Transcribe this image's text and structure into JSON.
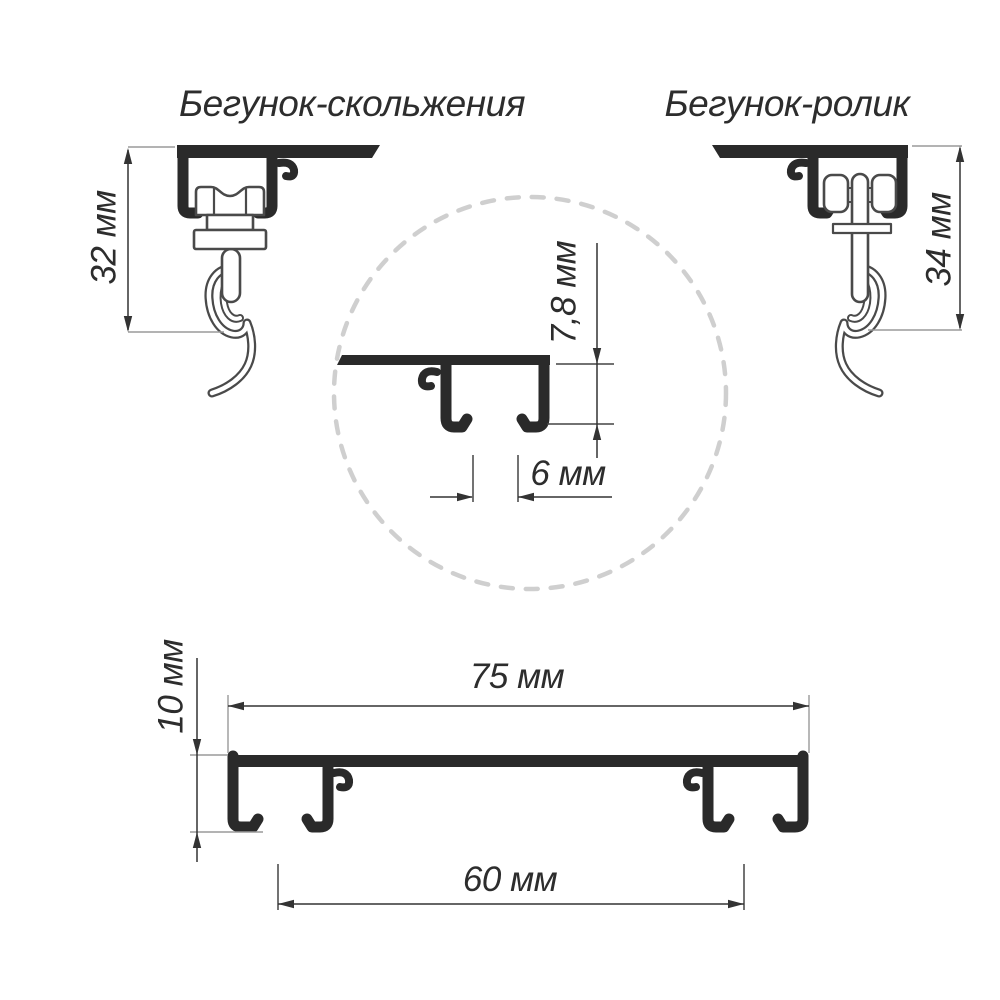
{
  "titles": {
    "left": "Бегунок-скольжения",
    "right": "Бегунок-ролик"
  },
  "dimensions": {
    "slider_runner_height": "32 мм",
    "roller_runner_height": "34 мм",
    "detail_channel_height": "7,8 мм",
    "detail_slot_width": "6 мм",
    "profile_total_width": "75 мм",
    "profile_height": "10 мм",
    "channel_spacing": "60 мм"
  },
  "colors": {
    "background": "#ffffff",
    "profile_fill": "#2a2a2a",
    "part_outline": "#4a4a4a",
    "dimension_line": "#333333",
    "witness_line": "#9a9a9a",
    "detail_tick": "#444444",
    "detail_circle": "#cfcfcf",
    "text": "#2d2d2d"
  }
}
